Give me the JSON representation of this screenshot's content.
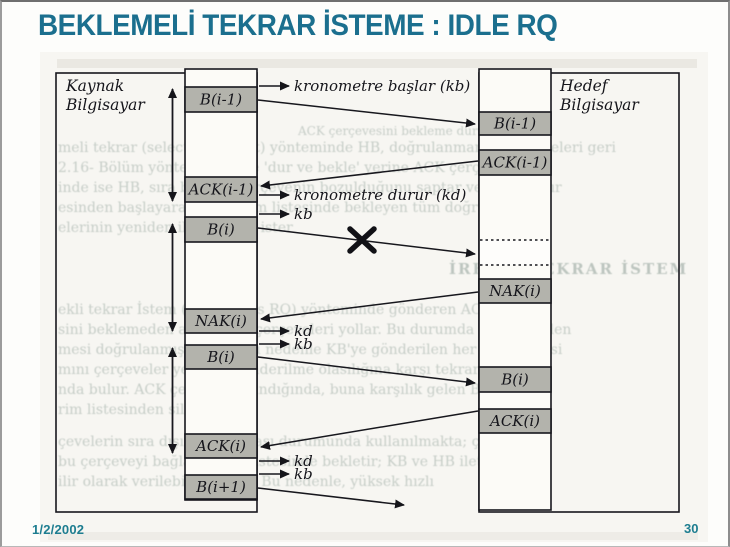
{
  "slide": {
    "title": "BEKLEMELİ TEKRAR İSTEME : IDLE RQ",
    "date": "1/2/2002",
    "page_number": "30",
    "title_color": "#1b6f8e"
  },
  "diagram": {
    "source_label": [
      "Kaynak",
      "Bilgisayar"
    ],
    "target_label": [
      "Hedef",
      "Bilgisayar"
    ],
    "box_fill": "#b3b3ac",
    "line_color": "#17171d",
    "source_boxes": [
      {
        "label": "B(i-1)",
        "y": 85,
        "h": 25
      },
      {
        "label": "ACK(i-1)",
        "y": 175,
        "h": 25
      },
      {
        "label": "B(i)",
        "y": 215,
        "h": 25
      },
      {
        "label": "NAK(i)",
        "y": 307,
        "h": 24
      },
      {
        "label": "B(i)",
        "y": 343,
        "h": 24
      },
      {
        "label": "ACK(i)",
        "y": 432,
        "h": 24
      },
      {
        "label": "B(i+1)",
        "y": 473,
        "h": 24
      }
    ],
    "target_boxes": [
      {
        "label": "B(i-1)",
        "y": 110,
        "h": 23
      },
      {
        "label": "ACK(i-1)",
        "y": 148,
        "h": 25
      },
      {
        "label": "",
        "y": 238,
        "h": 25,
        "dashed": true
      },
      {
        "label": "NAK(i)",
        "y": 277,
        "h": 24
      },
      {
        "label": "B(i)",
        "y": 365,
        "h": 25
      },
      {
        "label": "ACK(i)",
        "y": 407,
        "h": 24
      }
    ],
    "annotations": [
      {
        "label": "kronometre başlar (kb)",
        "y": 84
      },
      {
        "label": "kronometre durur (kd)",
        "y": 193
      },
      {
        "label": "kb",
        "y": 212
      },
      {
        "label": "kd",
        "y": 329
      },
      {
        "label": "kb",
        "y": 342
      },
      {
        "label": "kd",
        "y": 459
      },
      {
        "label": "kb",
        "y": 472
      }
    ],
    "transfers": [
      {
        "from": "source",
        "y1": 98,
        "y2": 122
      },
      {
        "from": "target",
        "y1": 159,
        "y2": 184
      },
      {
        "from": "source",
        "y1": 226,
        "y2": 252,
        "lost": true
      },
      {
        "from": "target",
        "y1": 290,
        "y2": 317
      },
      {
        "from": "source",
        "y1": 355,
        "y2": 381
      },
      {
        "from": "target",
        "y1": 409,
        "y2": 445
      },
      {
        "from": "source",
        "y1": 486,
        "y2": 503,
        "partial": true
      }
    ],
    "timeout_spans": [
      {
        "y1": 87,
        "y2": 199
      },
      {
        "y1": 222,
        "y2": 329
      },
      {
        "y1": 346,
        "y2": 451
      }
    ],
    "ghost_lines": [
      {
        "text": "ACK çerçevesini bekleme durumu",
        "x": 296,
        "y": 133,
        "size": 12
      },
      {
        "text": "meli tekrar (selective repeat) yönteminde HB, doğrulanmamış çerçeveleri geri",
        "x": 56,
        "y": 150
      },
      {
        "text": "2.16- Bölüm yöntemine göre 'dur ve bekle' yerine ACK çerçevesinin",
        "x": 56,
        "y": 170
      },
      {
        "text": "inde ise HB, sıra bağımlı çerçevenin bozulduğunu saptar ve doğrulanır",
        "x": 56,
        "y": 190
      },
      {
        "text": "esinden başlayarak gönderim listesinde bekleyen tüm doğrulanm",
        "x": 56,
        "y": 210
      },
      {
        "text": "elerinin yeniden iletilmesini ister",
        "x": 56,
        "y": 230
      },
      {
        "text": "İREKLİ TEKRAR İSTEM",
        "x": 447,
        "y": 272,
        "size": 15,
        "bold": true
      },
      {
        "text": "ekli tekrar İstem (continuous RQ) yönteminde gönderen ACK çerçe",
        "x": 56,
        "y": 312
      },
      {
        "text": "sini beklemeden art arda B çerçeveleri yollar. Bu durumda KB'de birden",
        "x": 56,
        "y": 332
      },
      {
        "text": "mesi doğrulanmış bekler. Bu nedenle KB'ye gönderilen her B çerçevesi",
        "x": 56,
        "y": 352
      },
      {
        "text": "mını çerçeveler yeniden gönderilme olasılığına karşı tekrar el",
        "x": 56,
        "y": 372
      },
      {
        "text": "nda bulur. ACK çerçevesi alındığında, buna karşılık gelen B çerçevesi",
        "x": 56,
        "y": 392
      },
      {
        "text": "rim listesinden silinir",
        "x": 56,
        "y": 412
      },
      {
        "text": "çevelerin sıra dışında alınması durumunda kullanılmakta; çerçevele",
        "x": 56,
        "y": 444
      },
      {
        "text": "bu çerçeveyi bağlantı alan listesinde bekletir; KB ve HB ilet",
        "x": 56,
        "y": 464
      },
      {
        "text": "ilir olarak verilebilmektedir. Bu nedenle, yüksek hızlı",
        "x": 56,
        "y": 484
      }
    ]
  }
}
